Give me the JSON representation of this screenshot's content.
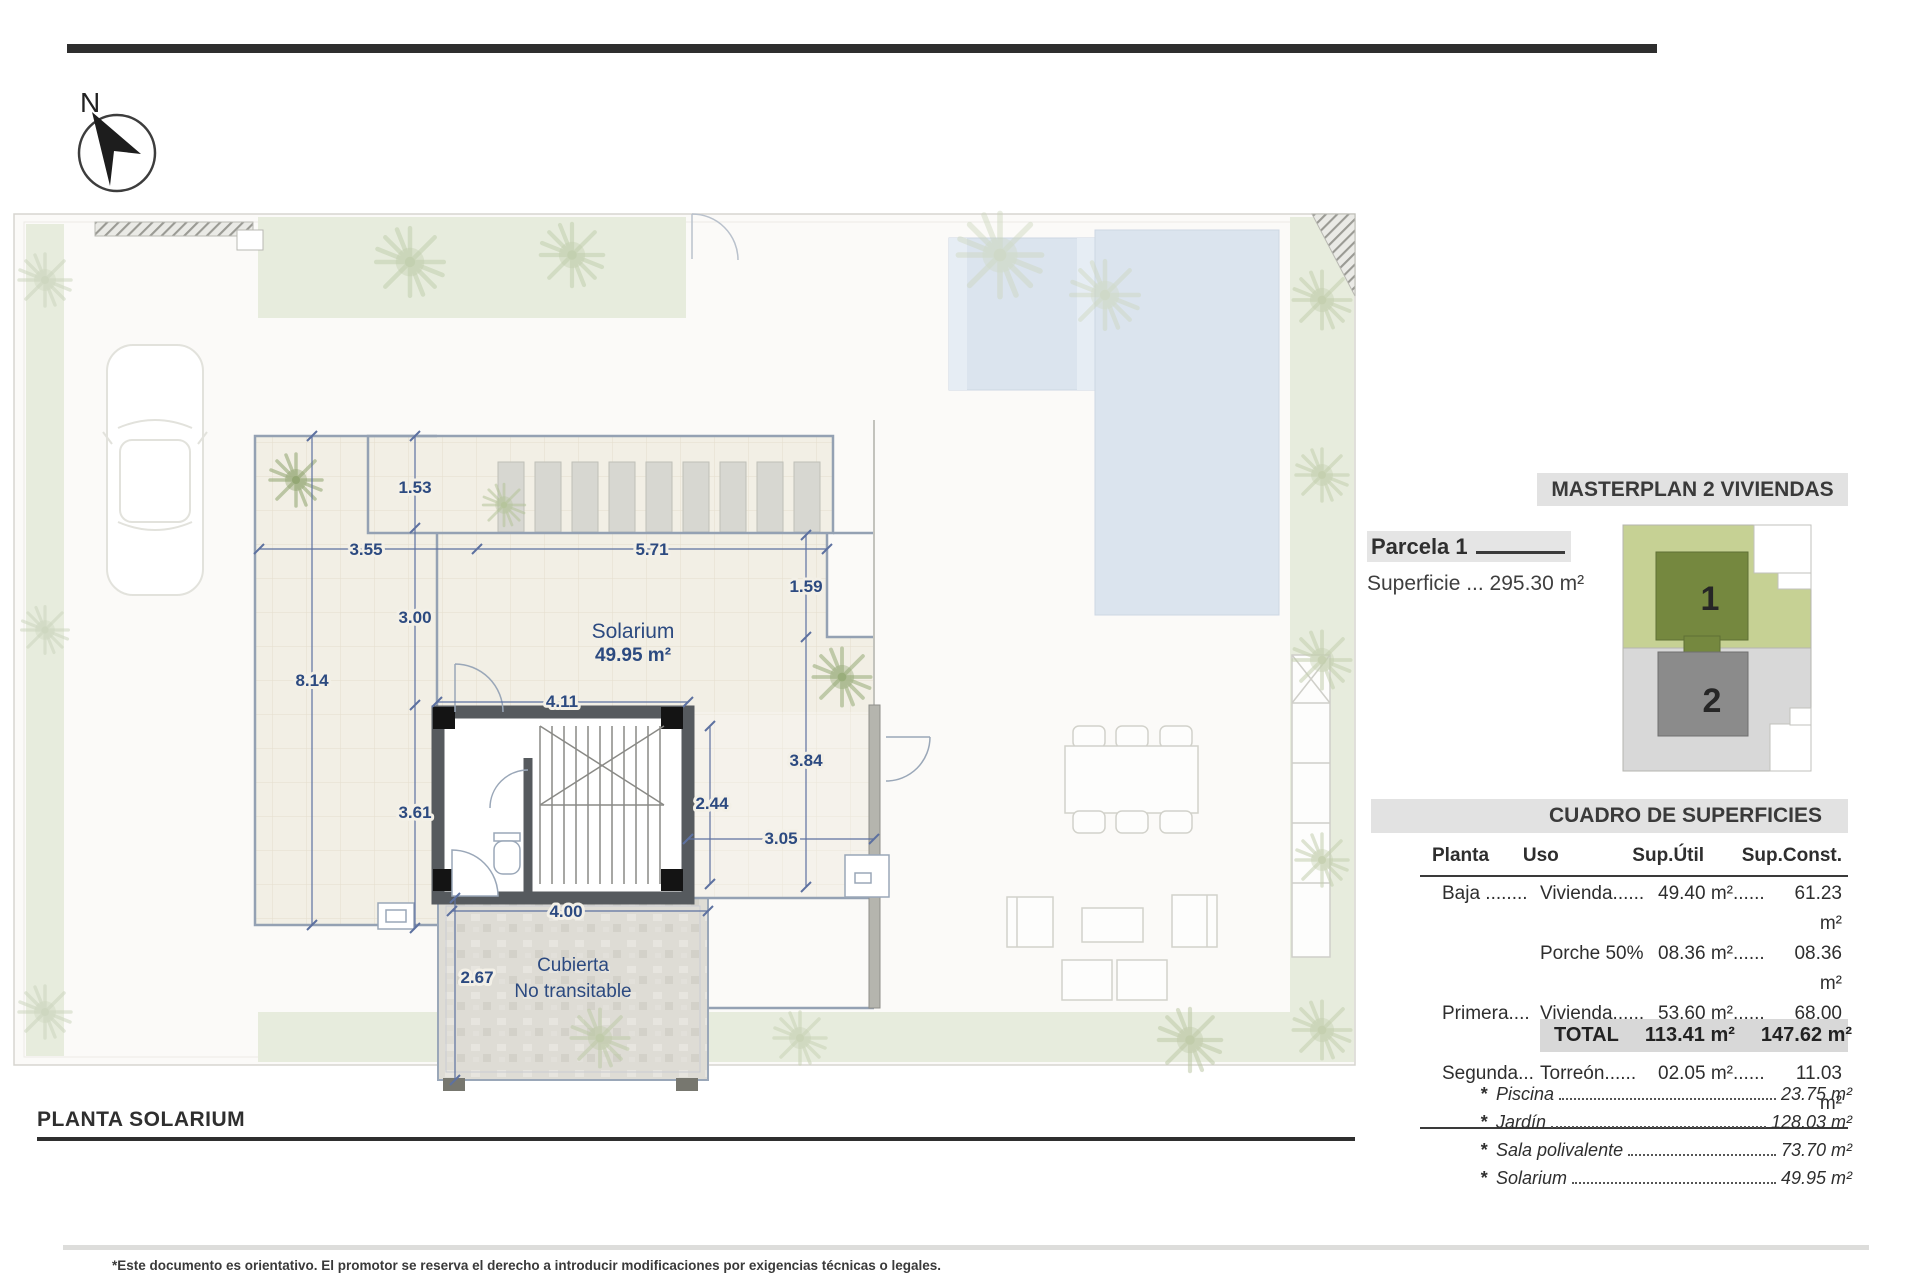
{
  "page": {
    "north_label": "N",
    "plan_title": "PLANTA SOLARIUM",
    "disclaimer": "*Este documento es orientativo. El promotor se reserva el derecho a introducir modificaciones por exigencias técnicas o legales."
  },
  "plan": {
    "rooms": {
      "solarium_name": "Solarium",
      "solarium_area": "49.95 m²",
      "cubierta_line1": "Cubierta",
      "cubierta_line2": "No transitable"
    },
    "dims": [
      "1.53",
      "3.55",
      "5.71",
      "1.59",
      "3.00",
      "8.14",
      "4.11",
      "3.61",
      "2.44",
      "3.05",
      "3.84",
      "4.00",
      "2.67"
    ]
  },
  "sidebar": {
    "masterplan_title": "MASTERPLAN 2 VIVIENDAS",
    "parcela_label": "Parcela 1",
    "superficie": "Superficie ... 295.30 m²",
    "minimap": {
      "unit1": "1",
      "unit2": "2"
    },
    "table": {
      "title": "CUADRO DE SUPERFICIES",
      "headers": [
        "Planta",
        "Uso",
        "Sup.Útil",
        "Sup.Const."
      ],
      "rows": [
        [
          "Baja ........",
          "Vivienda......",
          "49.40 m²......",
          "61.23 m²"
        ],
        [
          "",
          "Porche 50%",
          "08.36 m²......",
          "08.36 m²"
        ],
        [
          "Primera....",
          "Vivienda......",
          "53.60 m²......",
          "68.00 m²"
        ],
        [
          "Segunda...",
          "Torreón......",
          "02.05 m²......",
          "11.03 m²"
        ]
      ],
      "total_label": "TOTAL",
      "total_util": "113.41 m²",
      "total_const": "147.62 m²"
    },
    "extras_bullet": "*",
    "extras": [
      {
        "label": "Piscina",
        "value": "23.75 m²"
      },
      {
        "label": "Jardín",
        "value": "128.03 m²"
      },
      {
        "label": "Sala polivalente",
        "value": "73.70 m²"
      },
      {
        "label": "Solarium",
        "value": "49.95 m²"
      }
    ]
  }
}
